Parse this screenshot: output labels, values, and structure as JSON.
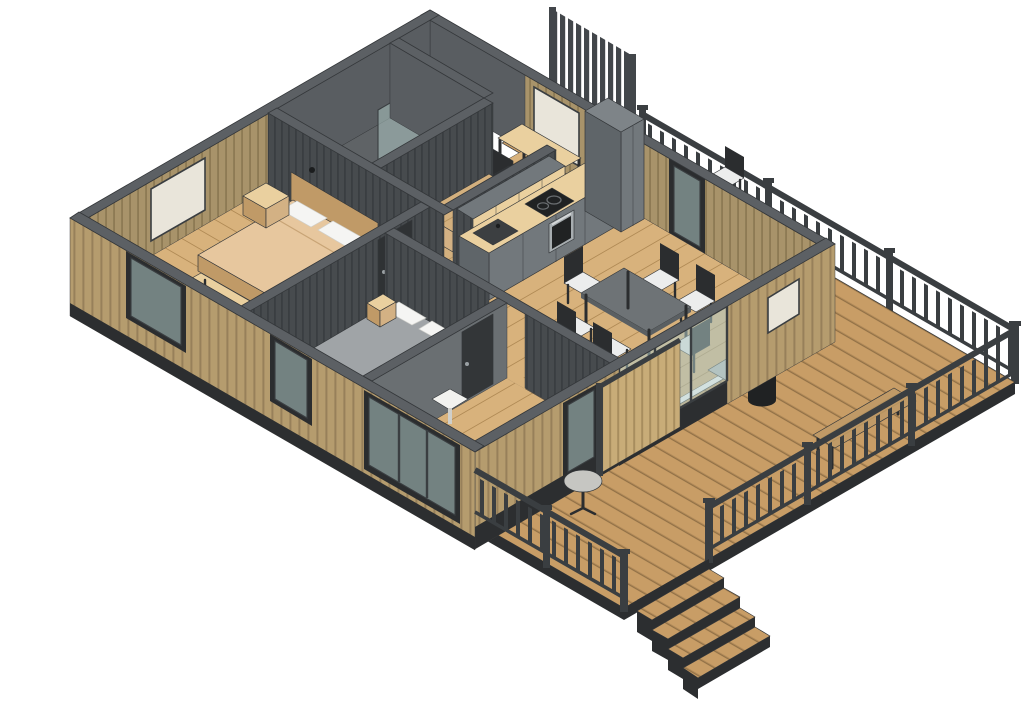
{
  "scene": {
    "type": "isometric-architectural-cutaway",
    "description": "3D isometric cutaway rendering of a single-storey cabin with wrap-around wooden deck",
    "background": "#ffffff"
  },
  "palette": {
    "bg": "#ffffff",
    "outline": "#34373a",
    "deck_wood": "#c89d66",
    "deck_seam": "#8f6f45",
    "floor_wood": "#d8b27c",
    "floor_seam": "#b08a55",
    "wall_cut_top": "#5c6064",
    "wall_dark": "#474b4e",
    "wall_dark_stripe": "#3a3e41",
    "wall_olive": "#a8936a",
    "wall_olive_stripe": "#8b7852",
    "siding": "#b59c6e",
    "siding_stripe": "#97805a",
    "plinth": "#2c2e30",
    "glass": "#aec8c4",
    "glass_frame": "#3a3e41",
    "railing": "#3a3e41",
    "fence": "#42464a",
    "sauna_wood": "#d3b07e",
    "sauna_stripe": "#b5935f",
    "cabinet": "#72787c",
    "cabinet_dark": "#5f6569",
    "counter_wood": "#ead09f",
    "appliance_black": "#202223",
    "steel": "#a7adb0",
    "table_top": "#6e7376",
    "chair_frame": "#2b2d2f",
    "seat_white": "#eceded",
    "bed_tan": "#e7c79e",
    "bed_tan_side": "#d3b184",
    "bed_gray": "#a0a4a7",
    "bed_gray_side": "#8b8f92",
    "pillow": "#f5f5f3",
    "wood_frame": "#c09a67",
    "bedroom2_floor": "#8f9396",
    "bath_floor": "#5f6366",
    "bath_wall": "#595d61",
    "screen_slat": "#c8ac78",
    "screen_stripe": "#a78d5e"
  },
  "rooms": [
    {
      "name": "back-deck",
      "floor": "deck-wood"
    },
    {
      "name": "terrace-deck",
      "floor": "deck-wood"
    },
    {
      "name": "office-nook",
      "floor": "plank-wood"
    },
    {
      "name": "bathroom",
      "floor": "dark-tile"
    },
    {
      "name": "sauna",
      "floor": "sauna-wood"
    },
    {
      "name": "kitchen",
      "floor": "plank-wood"
    },
    {
      "name": "living-dining",
      "floor": "plank-wood"
    },
    {
      "name": "master-bedroom",
      "floor": "plank-wood"
    },
    {
      "name": "bedroom-2",
      "floor": "gray-concrete"
    },
    {
      "name": "entry-hall",
      "floor": "plank-wood"
    }
  ],
  "furniture": [
    "desk",
    "office-chair",
    "shower-head",
    "shower-glass",
    "sauna-benches",
    "kitchen-counter",
    "kitchen-sink",
    "cooktop",
    "oven",
    "upper-shelves",
    "tall-cabinet",
    "dining-table",
    "dining-chairs",
    "fireplace-stove",
    "lounge-chair",
    "master-bed",
    "nightstands",
    "foot-bench",
    "bedroom2-bed",
    "bedroom2-nightstand",
    "outdoor-table",
    "outdoor-chairs",
    "deck-bench",
    "round-bistro-table",
    "slat-screen"
  ],
  "counts": {
    "stair_steps": 4,
    "dining_chairs": 6,
    "outdoor_chairs": 3,
    "railing_sections": 3,
    "railing_posts": 8,
    "fence_slats": 10,
    "master_pillows": 2,
    "bedroom2_pillows": 2,
    "sauna_bench_levels": 2,
    "kitchen_upper_shelves": 4,
    "glass_facade_panes": 3
  }
}
